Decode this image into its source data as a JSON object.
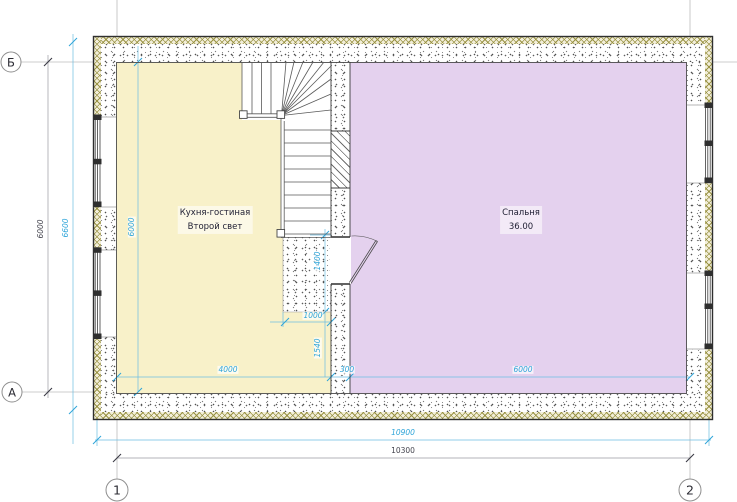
{
  "plan": {
    "axis_markers": {
      "row_top": "Б",
      "row_bottom": "А",
      "col_left": "1",
      "col_right": "2"
    },
    "rooms": [
      {
        "id": "kitchen-living",
        "label_line1": "Кухня-гостиная",
        "label_line2": "Второй свет",
        "fill": "#f8f1c9"
      },
      {
        "id": "bedroom",
        "label_line1": "Спальня",
        "label_line2": "36.00",
        "fill": "#e4d1ee"
      }
    ],
    "dimensions": {
      "axis_height_dark": "6000",
      "outer_height": "6600",
      "inner_height": "6000",
      "stair_void_height": "1400",
      "stair_void_width": "1000",
      "below_void_height": "1540",
      "kitchen_width": "4000",
      "partition_thickness": "300",
      "bedroom_width": "6000",
      "outer_width": "10900",
      "axis_width": "10300"
    },
    "colors": {
      "dim_accent": "#2fa5d9",
      "dim_dark": "#45454f",
      "insulation_hatch": "#968f3e",
      "kitchen_fill": "#f8f1c9",
      "bedroom_fill": "#e4d1ee"
    }
  }
}
